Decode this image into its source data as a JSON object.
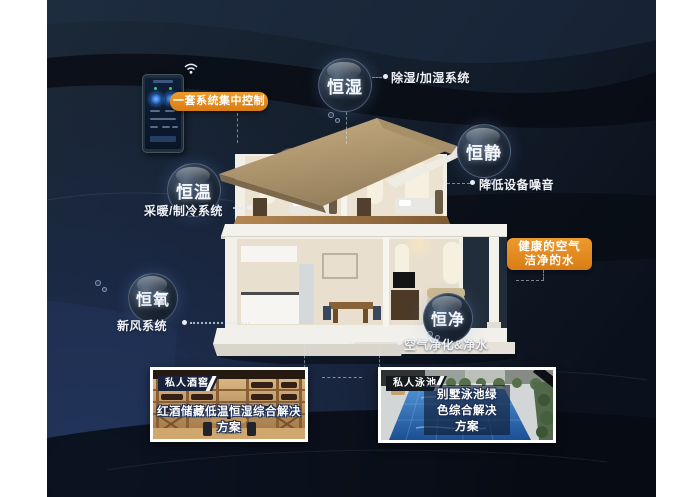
{
  "colors": {
    "page_bg": "#ffffff",
    "panel_base": "#141f2e",
    "panel_deep": "#090d15",
    "accent_orange": "#e1871f",
    "bubble_rim": "#a5c3eb",
    "roof_tan": "#b79b72",
    "pool_blue": "#2a66ab",
    "text_light": "#f2f5fa"
  },
  "control": {
    "label": "一套系统集中控制"
  },
  "bubbles": [
    {
      "label": "恒湿",
      "note": "除湿/加湿系统"
    },
    {
      "label": "恒静",
      "note": "降低设备噪音"
    },
    {
      "label": "恒温",
      "note": "采暖/制冷系统"
    },
    {
      "label": "恒氧",
      "note": "新风系统"
    },
    {
      "label": "恒净",
      "note": "空气净化&净水"
    }
  ],
  "callout": {
    "line1": "健康的空气",
    "line2": "洁净的水"
  },
  "photos": [
    {
      "tag": "私人酒窖",
      "caption": "红酒储藏低温恒湿综合解决方案"
    },
    {
      "tag": "私人泳池",
      "caption": "别墅泳池绿色综合解决方案"
    }
  ]
}
